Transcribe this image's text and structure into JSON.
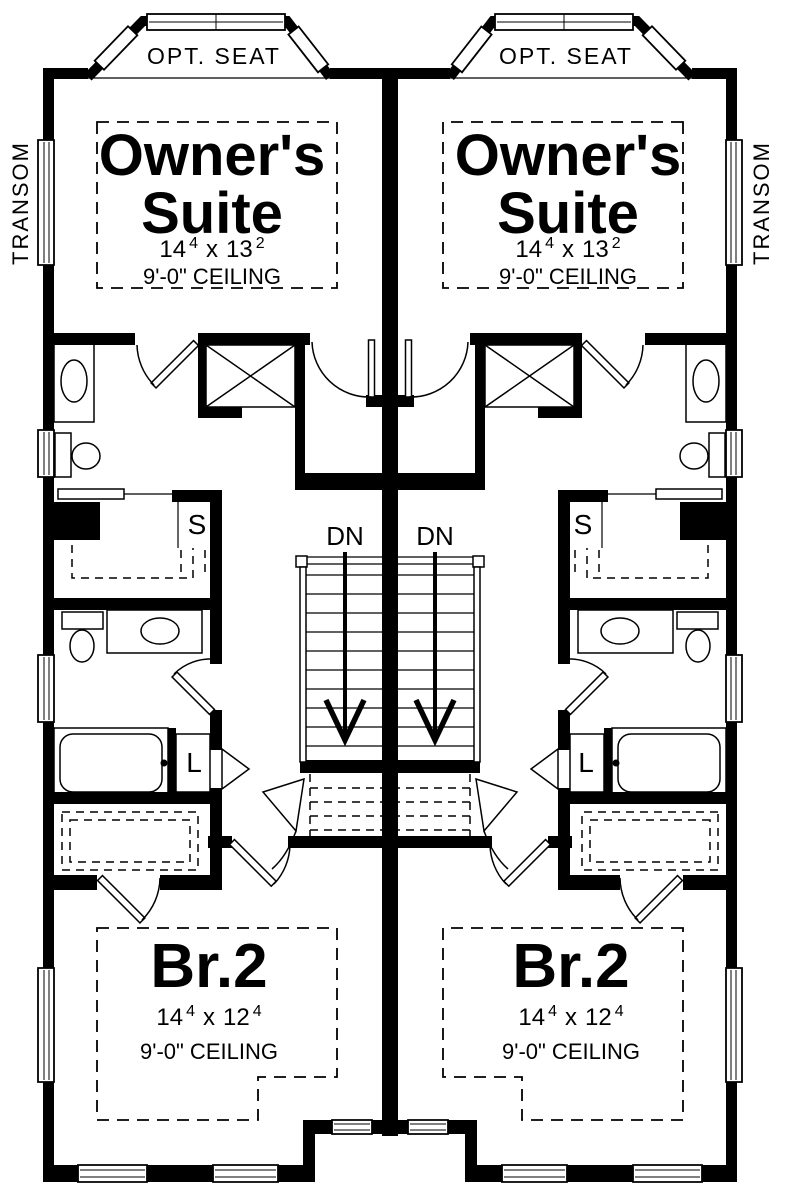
{
  "drawing": {
    "background": "#ffffff",
    "line_color": "#000000"
  },
  "units": {
    "left": {
      "bay_window_label": "OPT. SEAT",
      "transom_label": "TRANSOM",
      "owner_suite": {
        "name_line1": "Owner's",
        "name_line2": "Suite",
        "dim_width_ft": "14",
        "dim_width_sup": "4",
        "dim_sep": "x",
        "dim_depth_ft": "13",
        "dim_depth_sup": "2",
        "ceiling": "9'-0\" CEILING"
      },
      "stair_label": "DN",
      "shelf_label": "S",
      "linen_label": "L",
      "bedroom2": {
        "name": "Br.2",
        "dim_width_ft": "14",
        "dim_width_sup": "4",
        "dim_sep": "x",
        "dim_depth_ft": "12",
        "dim_depth_sup": "4",
        "ceiling": "9'-0\" CEILING"
      }
    },
    "right": {
      "bay_window_label": "OPT. SEAT",
      "transom_label": "TRANSOM",
      "owner_suite": {
        "name_line1": "Owner's",
        "name_line2": "Suite",
        "dim_width_ft": "14",
        "dim_width_sup": "4",
        "dim_sep": "x",
        "dim_depth_ft": "13",
        "dim_depth_sup": "2",
        "ceiling": "9'-0\" CEILING"
      },
      "stair_label": "DN",
      "shelf_label": "S",
      "linen_label": "L",
      "bedroom2": {
        "name": "Br.2",
        "dim_width_ft": "14",
        "dim_width_sup": "4",
        "dim_sep": "x",
        "dim_depth_ft": "12",
        "dim_depth_sup": "4",
        "ceiling": "9'-0\" CEILING"
      }
    }
  }
}
